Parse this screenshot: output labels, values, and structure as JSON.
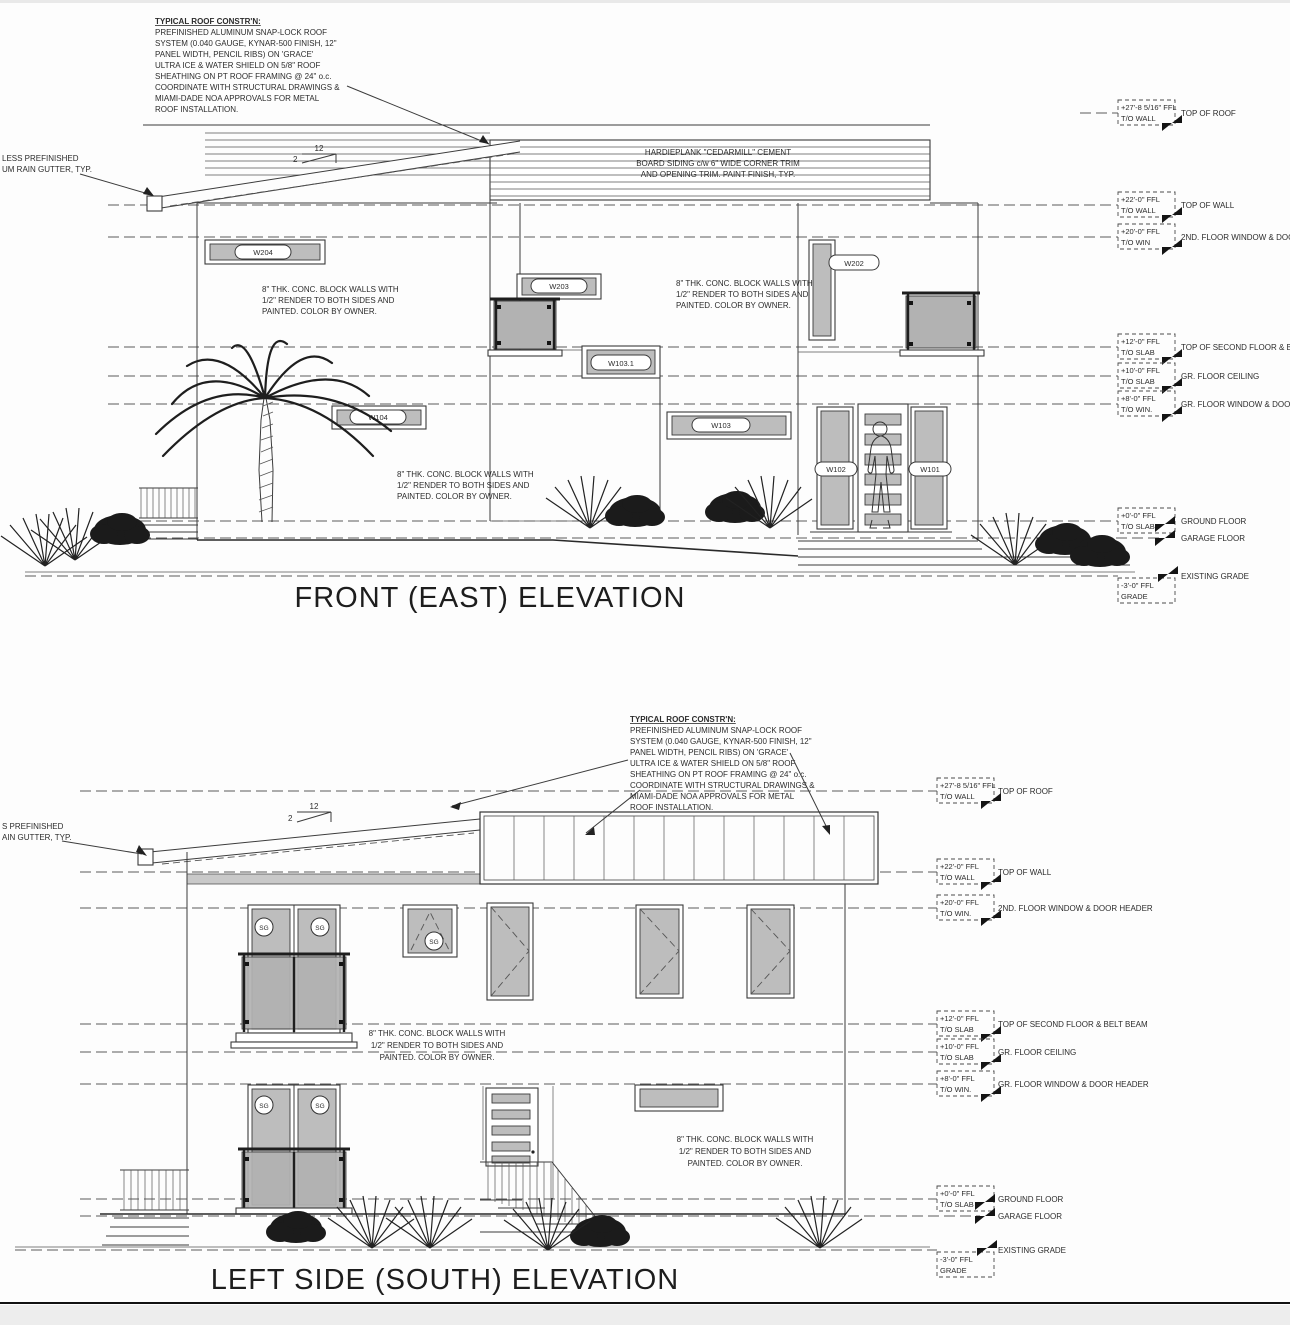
{
  "sg_label": "SG",
  "slope": {
    "run": "12",
    "rise": "2"
  },
  "notes": {
    "roof_constr": {
      "heading": "TYPICAL ROOF CONSTR'N:",
      "lines": [
        "PREFINISHED ALUMINUM SNAP-LOCK ROOF",
        "SYSTEM (0.040 GAUGE, KYNAR-500 FINISH, 12\"",
        "PANEL WIDTH, PENCIL RIBS) ON 'GRACE'",
        "ULTRA ICE & WATER SHIELD ON 5/8\" ROOF",
        "SHEATHING ON PT ROOF FRAMING @ 24\" o.c.",
        "COORDINATE WITH STRUCTURAL DRAWINGS &",
        "MIAMI-DADE NOA APPROVALS FOR METAL",
        "ROOF INSTALLATION."
      ]
    },
    "block_wall": {
      "lines": [
        "8\" THK. CONC. BLOCK WALLS WITH",
        "1/2\" RENDER TO BOTH SIDES AND",
        "PAINTED. COLOR BY OWNER."
      ]
    },
    "siding": {
      "lines": [
        "HARDIEPLANK \"CEDARMILL\" CEMENT",
        "BOARD SIDING c/w 6\" WIDE CORNER TRIM",
        "AND OPENING TRIM. PAINT FINISH, TYP."
      ]
    }
  },
  "front": {
    "title": "FRONT (EAST) ELEVATION",
    "gutter_note": {
      "lines": [
        "LESS PREFINISHED",
        "UM RAIN GUTTER, TYP."
      ]
    },
    "tags": {
      "w204": "W204",
      "w203": "W203",
      "w202": "W202",
      "w103_1": "W103.1",
      "w104": "W104",
      "w103": "W103",
      "w102": "W102",
      "w101": "W101"
    },
    "levels": [
      {
        "value": "+27'-8 5/16\" FFL",
        "ref": "T/O WALL",
        "label": "TOP OF ROOF"
      },
      {
        "value": "+22'-0\" FFL",
        "ref": "T/O WALL",
        "label": "TOP OF WALL"
      },
      {
        "value": "+20'-0\" FFL",
        "ref": "T/O WIN",
        "label": "2ND. FLOOR WINDOW & DOOR HEADER"
      },
      {
        "value": "+12'-0\" FFL",
        "ref": "T/O SLAB",
        "label": "TOP OF SECOND FLOOR & BELT BEAM"
      },
      {
        "value": "+10'-0\" FFL",
        "ref": "T/O SLAB",
        "label": "GR. FLOOR CEILING"
      },
      {
        "value": "+8'-0\" FFL",
        "ref": "T/O WIN.",
        "label": "GR. FLOOR WINDOW & DOOR HEADER"
      },
      {
        "value": "+0'-0\" FFL",
        "ref": "T/O SLAB",
        "label": "GROUND FLOOR"
      },
      {
        "label": "GARAGE FLOOR"
      },
      {
        "value": "-3'-0\" FFL",
        "ref": "GRADE",
        "label": "EXISTING GRADE"
      }
    ]
  },
  "left": {
    "title": "LEFT SIDE (SOUTH) ELEVATION",
    "gutter_note": {
      "lines": [
        "S PREFINISHED",
        "AIN GUTTER, TYP."
      ]
    },
    "levels": [
      {
        "value": "+27'-8 5/16\" FFL",
        "ref": "T/O WALL",
        "label": "TOP OF ROOF"
      },
      {
        "value": "+22'-0\" FFL",
        "ref": "T/O WALL",
        "label": "TOP OF WALL"
      },
      {
        "value": "+20'-0\" FFL",
        "ref": "T/O WIN.",
        "label": "2ND. FLOOR WINDOW & DOOR HEADER"
      },
      {
        "value": "+12'-0\" FFL",
        "ref": "T/O SLAB",
        "label": "TOP OF SECOND FLOOR & BELT BEAM"
      },
      {
        "value": "+10'-0\" FFL",
        "ref": "T/O SLAB",
        "label": "GR. FLOOR CEILING"
      },
      {
        "value": "+8'-0\" FFL",
        "ref": "T/O WIN.",
        "label": "GR. FLOOR WINDOW & DOOR HEADER"
      },
      {
        "value": "+0'-0\" FFL",
        "ref": "T/O SLAB",
        "label": "GROUND FLOOR"
      },
      {
        "label": "GARAGE FLOOR"
      },
      {
        "value": "-3'-0\" FFL",
        "ref": "GRADE",
        "label": "EXISTING GRADE"
      }
    ]
  }
}
